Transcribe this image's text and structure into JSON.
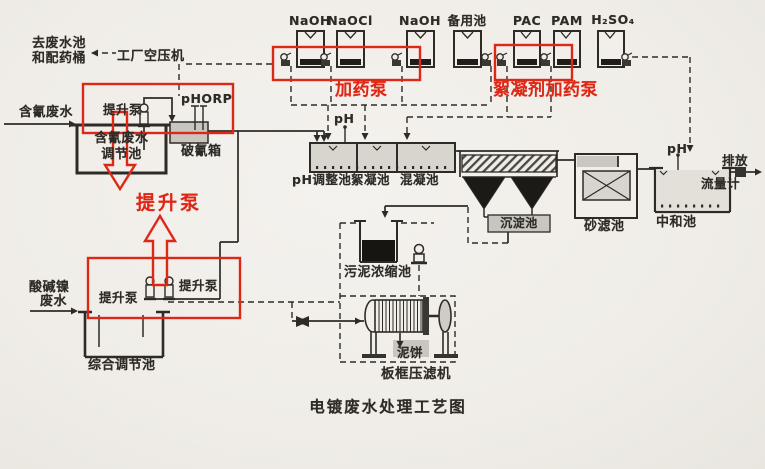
{
  "title": "电镀废水处理工艺图",
  "colors": {
    "paper": "#f2efea",
    "ink": "#2e2b26",
    "red": "#de2817",
    "gray_fill": "#c9c6bf"
  },
  "notes": {
    "to_waste_1": "去废水池",
    "to_waste_2": "和配药桶",
    "air_compressor": "工厂空压机"
  },
  "chemical_tanks": [
    {
      "label": "NaOH"
    },
    {
      "label": "NaOCl"
    },
    {
      "label": "NaOH"
    },
    {
      "label": "备用池"
    },
    {
      "label": "PAC"
    },
    {
      "label": "PAM"
    },
    {
      "label": "H₂SO₄"
    }
  ],
  "red_annotations": {
    "dosing_pump": "加药泵",
    "flocculant_dosing_pump": "絮凝剂加药泵",
    "lift_pump": "提升泵"
  },
  "streams": {
    "cyanide_in": "含氰废水",
    "acid_nickel_1": "酸碱镍",
    "acid_nickel_2": "废水",
    "discharge": "排放",
    "flow_meter": "流量计",
    "mud_cake": "泥饼"
  },
  "units": {
    "cyanide_tank_1": "含氰废水",
    "cyanide_tank_2": "调节池",
    "cyanide_breaker": "破氰箱",
    "ph_orp_meter": "pHORP",
    "ph_meter": "pH",
    "ph_adjust_tank": "pH调整池",
    "flocculation_tank": "絮凝池",
    "coagulation_tank": "混凝池",
    "sedimentation_tank": "沉淀池",
    "sand_filter": "砂滤池",
    "neutralization_tank": "中和池",
    "neutralization_ph": "pH",
    "sludge_thickener": "污泥浓缩池",
    "filter_press": "板框压滤机",
    "comprehensive_tank": "综合调节池"
  },
  "pumps": {
    "lift_top": "提升泵",
    "lift_b1": "提升泵",
    "lift_b2": "提升泵"
  }
}
